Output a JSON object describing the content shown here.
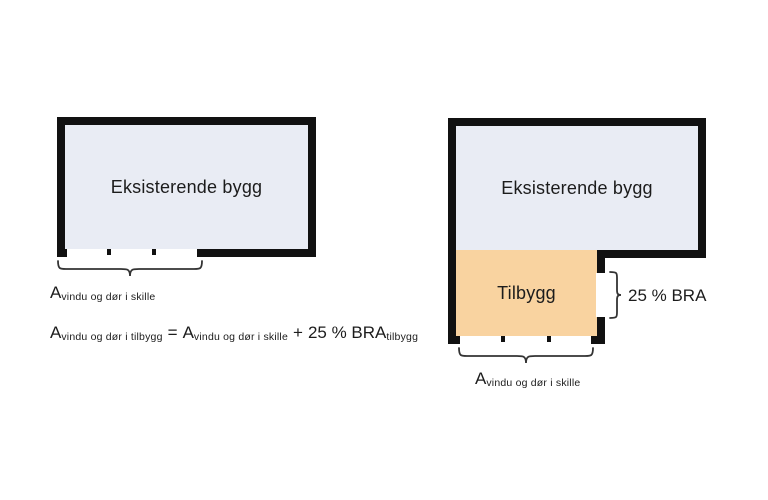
{
  "colors": {
    "existing_building_fill": "#e9ecf4",
    "extension_fill": "#f9d3a0",
    "wall": "#111111",
    "background": "#ffffff",
    "text": "#1c1c1c"
  },
  "diagram_left": {
    "building_label": "Eksisterende bygg",
    "area_label_main": "A",
    "area_label_sub": "vindu og dør i skille"
  },
  "diagram_right": {
    "building_label": "Eksisterende bygg",
    "extension_label": "Tilbygg",
    "bra_label": "25 % BRA",
    "area_label_main": "A",
    "area_label_sub": "vindu og dør i skille"
  },
  "formula": {
    "lhs_main": "A",
    "lhs_sub": "vindu og dør i tilbygg",
    "equals_sign": "=",
    "rhs1_main": "A",
    "rhs1_sub": "vindu og dør i skille",
    "plus_sign": "+",
    "rhs2_main": "25 % BRA",
    "rhs2_sub": "tilbygg"
  }
}
